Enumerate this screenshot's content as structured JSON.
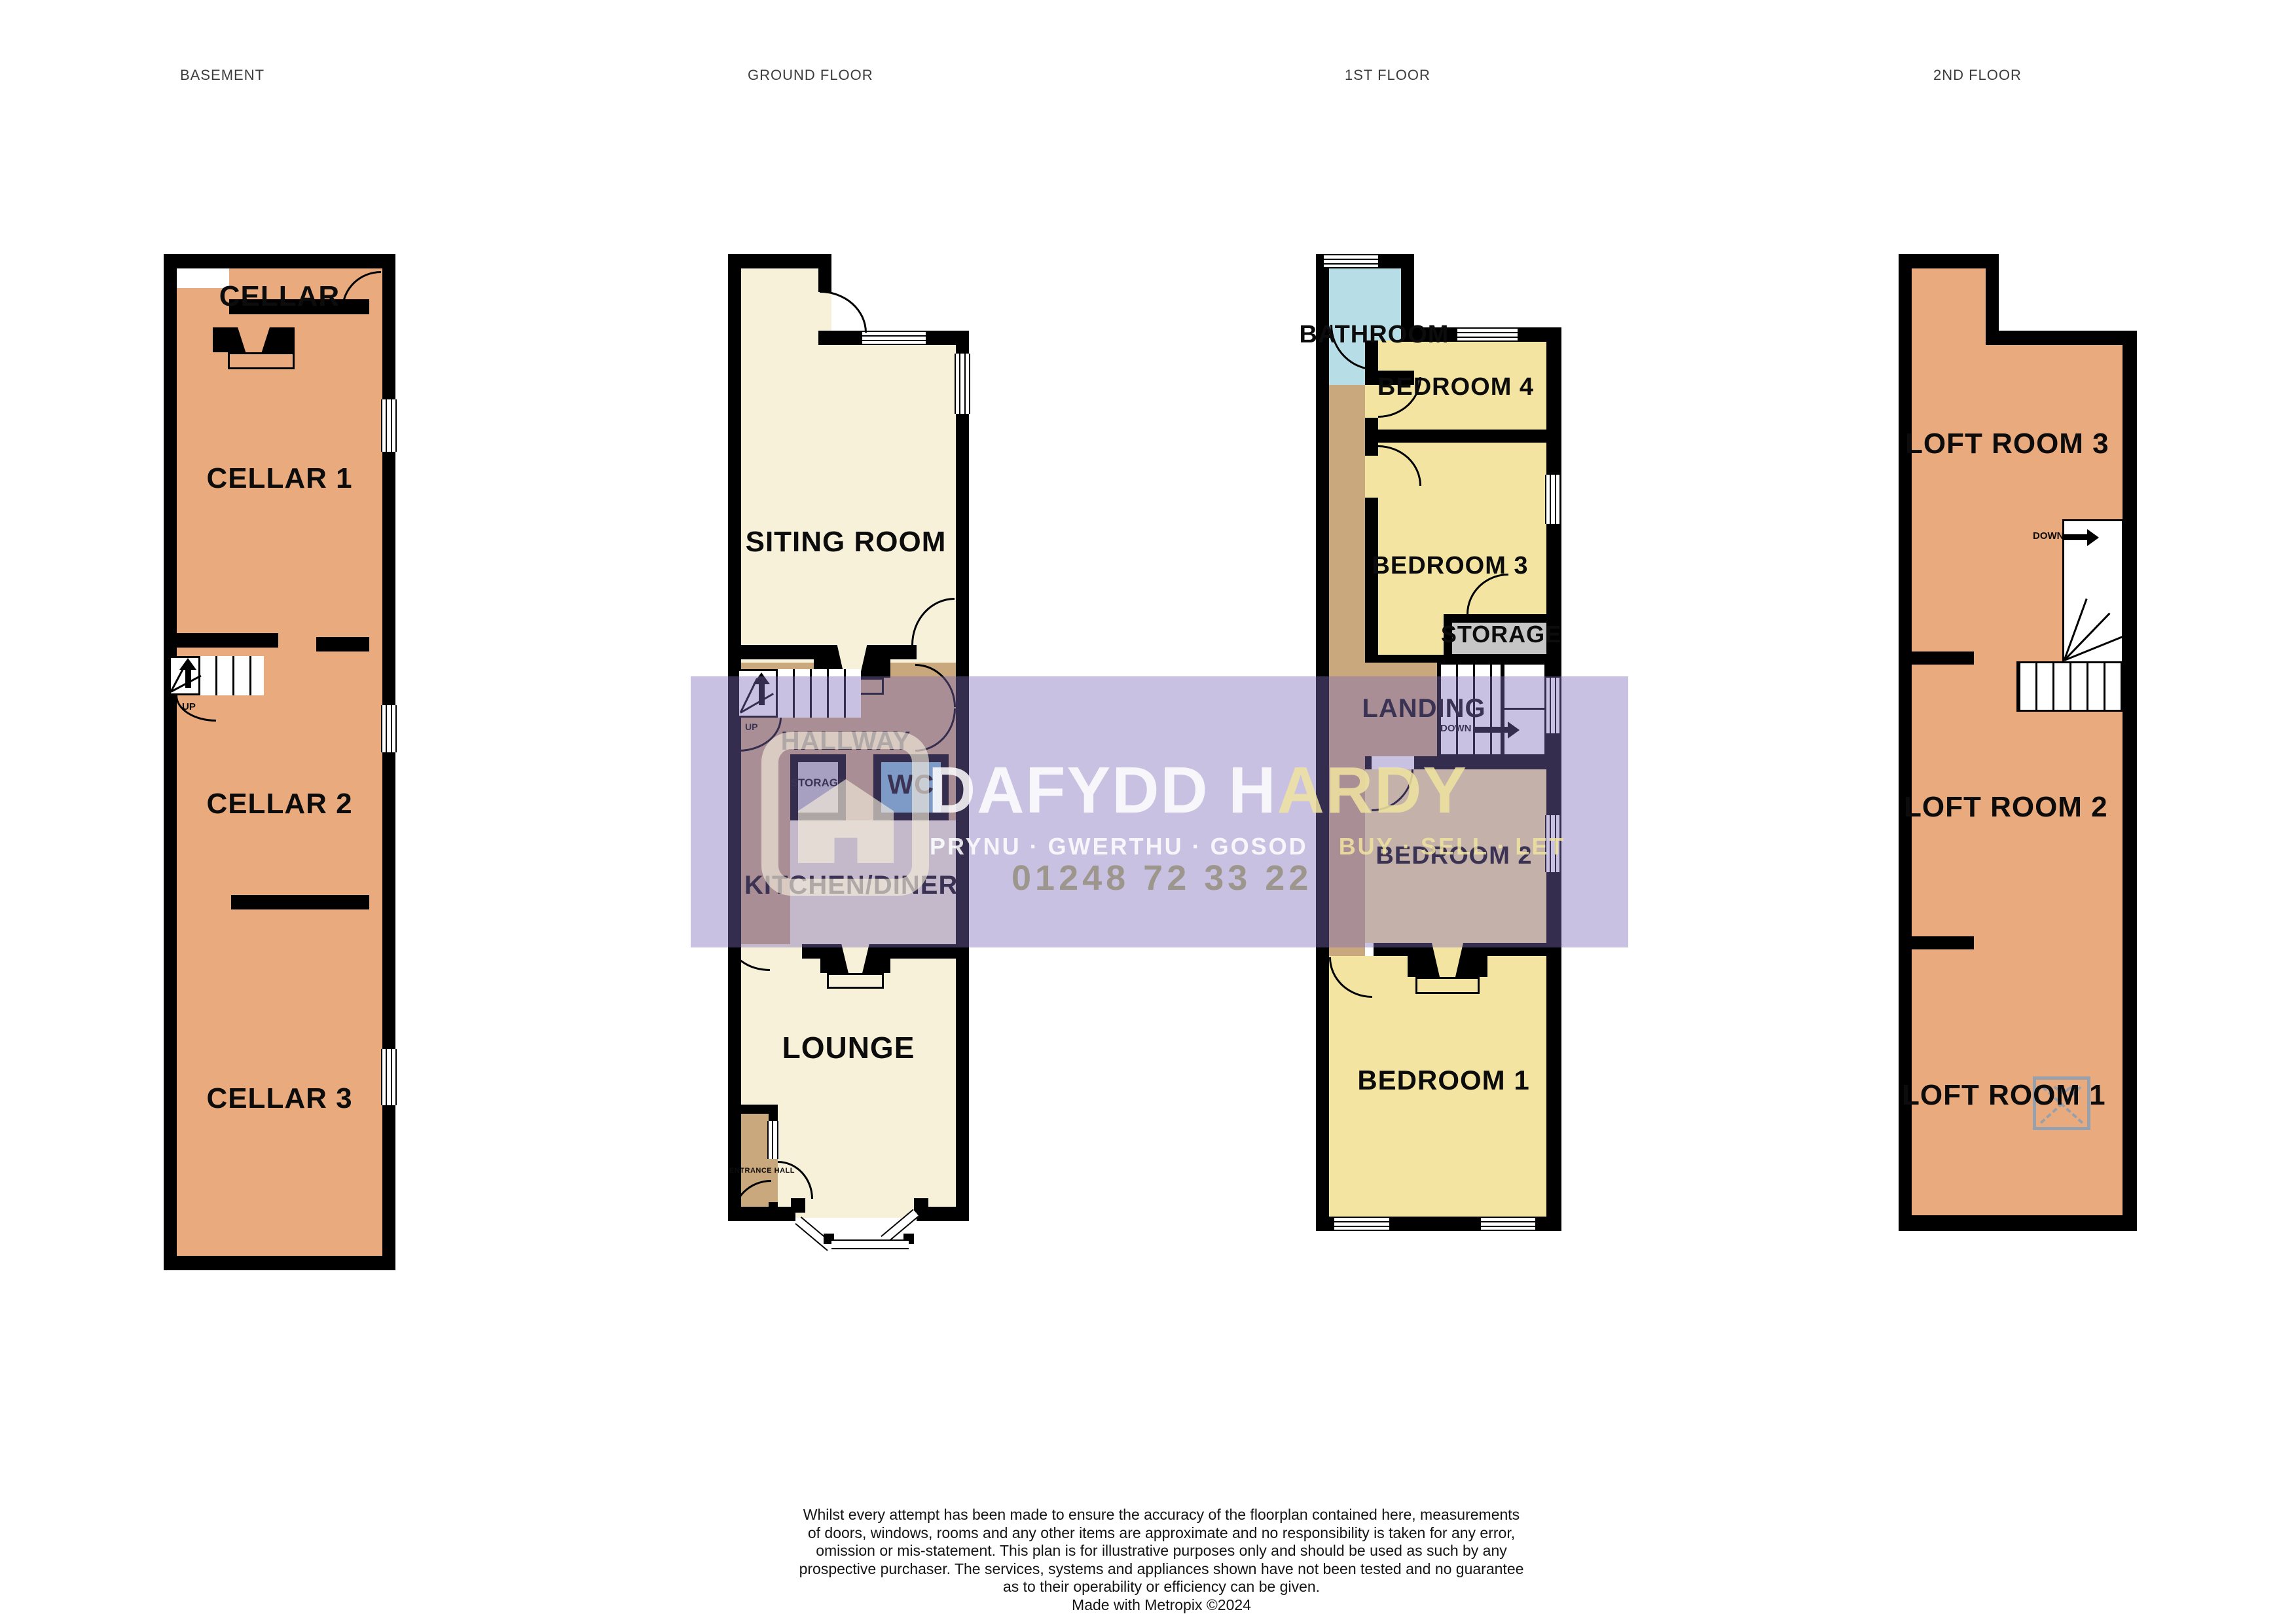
{
  "floors": {
    "basement": {
      "title": "BASEMENT",
      "cellar": "CELLAR",
      "cellar1": "CELLAR 1",
      "cellar2": "CELLAR 2",
      "cellar3": "CELLAR 3",
      "up": "UP"
    },
    "ground": {
      "title": "GROUND FLOOR",
      "siting_room": "SITING ROOM",
      "hallway": "HALLWAY",
      "storage": "STORAGE",
      "wc": "WC",
      "kitchen_diner": "KITCHEN/DINER",
      "lounge": "LOUNGE",
      "entrance_hall": "ENTRANCE HALL",
      "up": "UP"
    },
    "first": {
      "title": "1ST FLOOR",
      "bathroom": "BATHROOM",
      "bedroom4": "BEDROOM 4",
      "bedroom3": "BEDROOM 3",
      "storage": "STORAGE",
      "landing": "LANDING",
      "bedroom2": "BEDROOM 2",
      "bedroom1": "BEDROOM 1",
      "down": "DOWN"
    },
    "second": {
      "title": "2ND FLOOR",
      "loft3": "LOFT ROOM 3",
      "loft2": "LOFT ROOM 2",
      "loft1": "LOFT ROOM 1",
      "down": "DOWN"
    }
  },
  "watermark": {
    "brand_primary": "DAFYDD H",
    "brand_secondary": "ARDY",
    "tagline_welsh": "PRYNU · GWERTHU · GOSOD",
    "tagline_english": "BUY · SELL · LET",
    "phone": "01248 72 33 22"
  },
  "footer": {
    "line1": "Whilst every attempt has been made to ensure the accuracy of the floorplan contained here, measurements",
    "line2": "of doors, windows, rooms and any other items are approximate and no responsibility is taken for any error,",
    "line3": "omission or mis-statement. This plan is for illustrative purposes only and should be used as such by any",
    "line4": "prospective purchaser. The services, systems and appliances shown have not been tested and no guarantee",
    "line5": "as to their operability or efficiency can be given.",
    "line6": "Made with Metropix ©2024"
  },
  "colors": {
    "wall": "#000000",
    "cellar_loft_fill": "#e9ab7e",
    "living_cream": "#f7f1da",
    "bedroom_yellow": "#f4e4a1",
    "hall_tan": "#c9a87d",
    "bathroom_blue": "#b7dde6",
    "wc_blue": "#7fbcd2",
    "storage_grey": "#c6c6c6",
    "watermark_purple": "rgba(127,107,184,0.42)",
    "watermark_cream": "rgba(247,241,219,0.62)"
  }
}
